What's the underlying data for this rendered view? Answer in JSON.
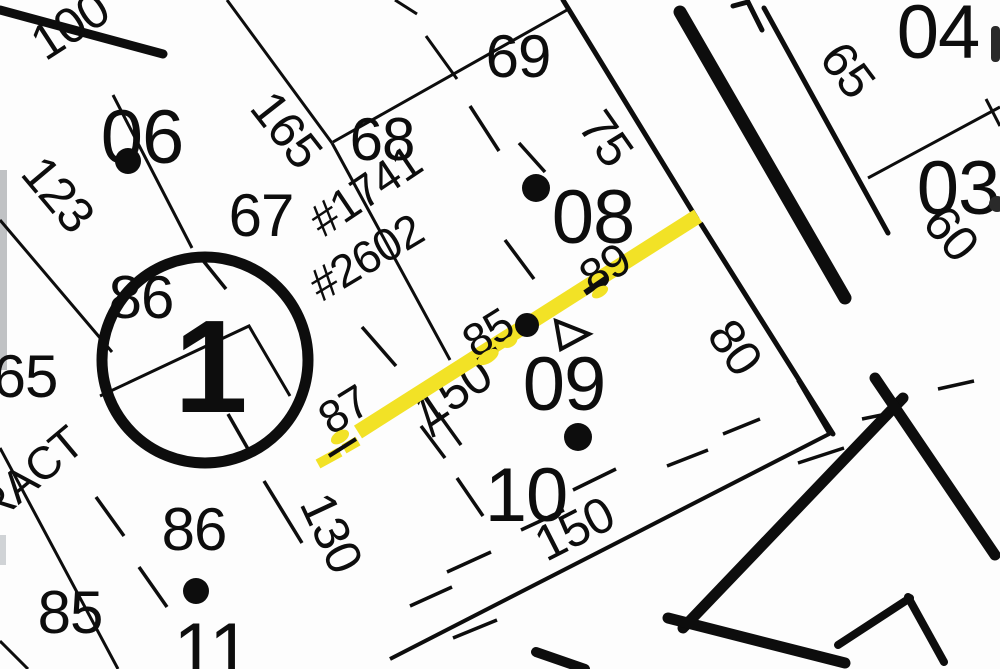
{
  "map": {
    "type": "cadastral-plat",
    "colors": {
      "paper": "#fdfdfd",
      "ink": "#0d0d0d",
      "highlight": "#F2E226"
    },
    "block": {
      "circle_label": "1"
    },
    "lot_numbers": {
      "lot06": "06",
      "lot67": "67",
      "lot68": "68",
      "lot69": "69",
      "lot08": "08",
      "lot09": "09",
      "lot10": "10",
      "lot11": "11",
      "lot04": "04",
      "lot03": "03",
      "lot85": "85",
      "lot86_upper": "86",
      "lot86_lower": "86"
    },
    "site_addresses": {
      "addr_1741": "#1741",
      "addr_2602": "#2602"
    },
    "dimensions": {
      "dim100": "100",
      "dim123": "123",
      "dim165": "165",
      "dim65_left": "65",
      "dim75": "75",
      "dim80": "80",
      "dim65_right": "65",
      "dim60": "60",
      "dim130": "130",
      "dim150_west": "150",
      "dim150_south": "150",
      "dim87": "87",
      "dim85_mid": "85",
      "dim89": "89"
    },
    "annotations": {
      "tract_label": "RACT"
    }
  }
}
